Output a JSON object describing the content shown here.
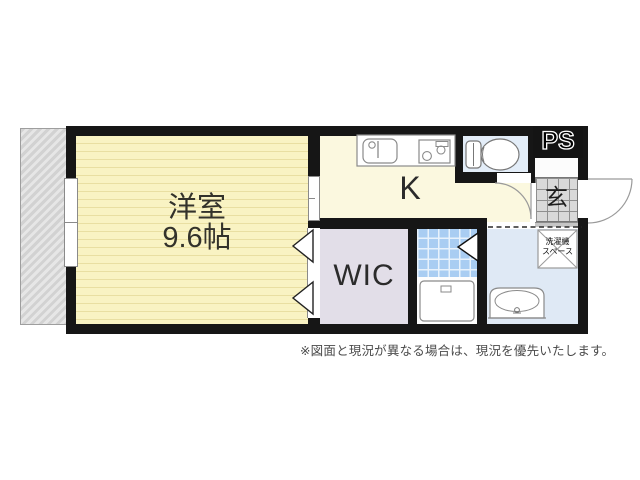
{
  "page": {
    "background_color": "#ffffff"
  },
  "plan": {
    "wall_color": "#161616",
    "rooms": {
      "western_room": {
        "label": "洋室",
        "size_label": "9.6帖",
        "fill": "#f9f3c3",
        "stripe_color": "#e9dfa2"
      },
      "kitchen": {
        "label": "K",
        "fill": "#fbf8df"
      },
      "wic": {
        "label": "WIC",
        "fill": "#e2dee8"
      },
      "toilet": {
        "fill": "#e3edf8"
      },
      "bath_tile": {
        "fill": "#a9cdf2"
      },
      "bathtub_room": {
        "fill": "#fdfdfd"
      },
      "washroom": {
        "fill": "#dfe9f5"
      },
      "genkan": {
        "label": "玄",
        "fill": "#d9d9d9"
      },
      "pipe_space": {
        "label": "PS",
        "fill": "#141414"
      }
    },
    "laundry_space": {
      "line1": "洗濯機",
      "line2": "スペース"
    },
    "fixture_icons": [
      "kitchen-sink-icon",
      "stove-icon",
      "toilet-icon",
      "bathtub-icon",
      "washbasin-icon",
      "window",
      "entrance-door-arc",
      "hall-door-arc",
      "wic-folding-door-icon",
      "bath-door-icon",
      "laundry-space-box"
    ],
    "balcony_hatch_color": "#d2d2d2"
  },
  "footer": {
    "disclaimer": "※図面と現況が異なる場合は、現況を優先いたします。"
  }
}
